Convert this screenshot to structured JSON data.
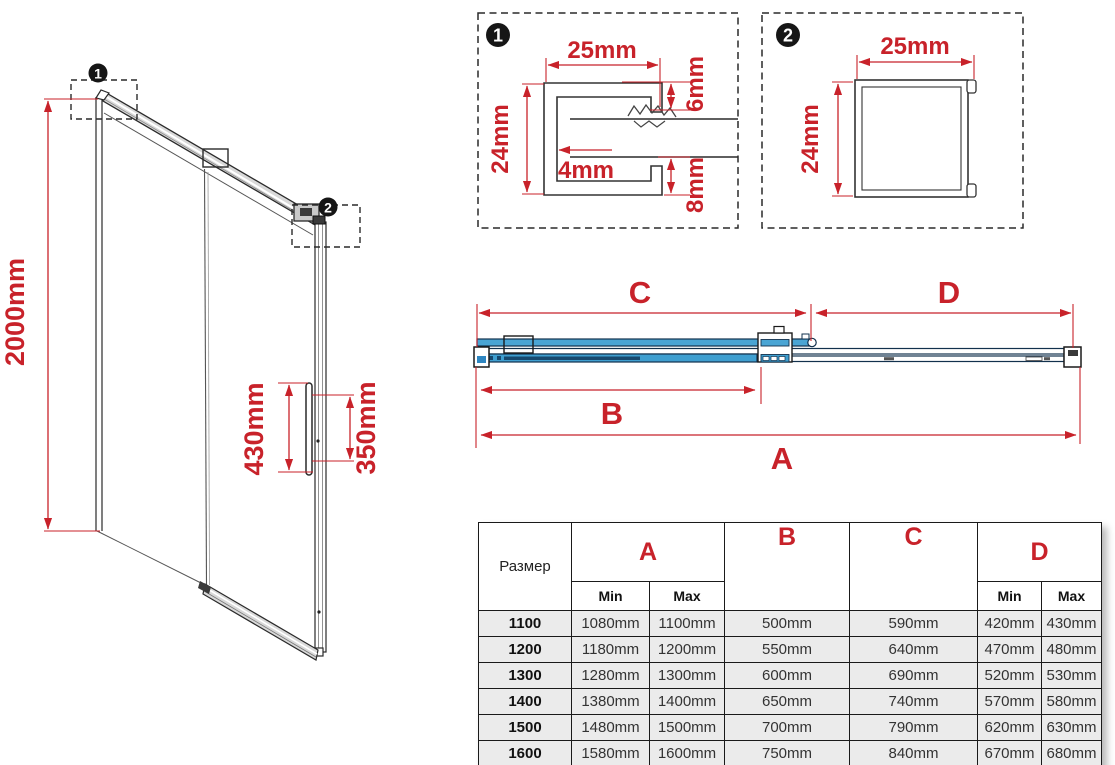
{
  "diagram": {
    "isometric": {
      "height_label": "2000mm",
      "handle_height_label": "430mm",
      "handle_cutout_label": "350mm",
      "callout_1": "1",
      "callout_2": "2"
    },
    "detail_1": {
      "badge": "1",
      "width_label": "25mm",
      "height_label": "24mm",
      "top_lip_label": "6mm",
      "wall_label": "4mm",
      "bottom_lip_label": "8mm"
    },
    "detail_2": {
      "badge": "2",
      "width_label": "25mm",
      "height_label": "24mm"
    },
    "section": {
      "dim_a": "A",
      "dim_b": "B",
      "dim_c": "C",
      "dim_d": "D"
    }
  },
  "table": {
    "header": {
      "size": "Размер",
      "a": "A",
      "b": "B",
      "c": "C",
      "d": "D",
      "min": "Min",
      "max": "Max"
    },
    "rows": [
      {
        "size": "1100",
        "a_min": "1080mm",
        "a_max": "1100mm",
        "b": "500mm",
        "c": "590mm",
        "d_min": "420mm",
        "d_max": "430mm"
      },
      {
        "size": "1200",
        "a_min": "1180mm",
        "a_max": "1200mm",
        "b": "550mm",
        "c": "640mm",
        "d_min": "470mm",
        "d_max": "480mm"
      },
      {
        "size": "1300",
        "a_min": "1280mm",
        "a_max": "1300mm",
        "b": "600mm",
        "c": "690mm",
        "d_min": "520mm",
        "d_max": "530mm"
      },
      {
        "size": "1400",
        "a_min": "1380mm",
        "a_max": "1400mm",
        "b": "650mm",
        "c": "740mm",
        "d_min": "570mm",
        "d_max": "580mm"
      },
      {
        "size": "1500",
        "a_min": "1480mm",
        "a_max": "1500mm",
        "b": "700mm",
        "c": "790mm",
        "d_min": "620mm",
        "d_max": "630mm"
      },
      {
        "size": "1600",
        "a_min": "1580mm",
        "a_max": "1600mm",
        "b": "750mm",
        "c": "840mm",
        "d_min": "670mm",
        "d_max": "680mm"
      }
    ]
  },
  "colors": {
    "red": "#c8222a",
    "blue_light": "#4aa5d4",
    "blue_mid": "#3f9fd0",
    "blue_dark": "#16486e"
  }
}
